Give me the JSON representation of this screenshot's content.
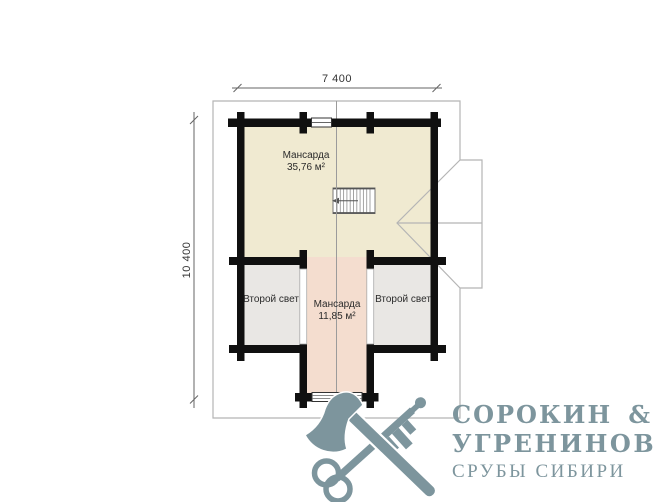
{
  "plan": {
    "dim_top": "7 400",
    "dim_left": "10 400",
    "rooms": [
      {
        "label": "Мансарда",
        "area": "35,76 м²"
      },
      {
        "label": "Второй свет",
        "area": ""
      },
      {
        "label": "Мансарда",
        "area": "11,85 м²"
      },
      {
        "label": "Второй свет",
        "area": ""
      }
    ],
    "colors": {
      "attic_fill": "#f0ead1",
      "second_light_fill": "#e9e7e4",
      "corridor_fill": "#f4ddcf",
      "wall": "#101010",
      "roof_outline": "#b5b5b5",
      "axis_line": "#9b9b9b",
      "dimension_line": "#666666"
    }
  },
  "logo": {
    "name_line1": "СОРОКИН",
    "ampersand": "&",
    "name_line2": "УГРЕНИНОВ",
    "tagline": "СРУБЫ СИБИРИ",
    "color": "#7d959d",
    "icon": "axe-and-key-crossed-icon"
  }
}
